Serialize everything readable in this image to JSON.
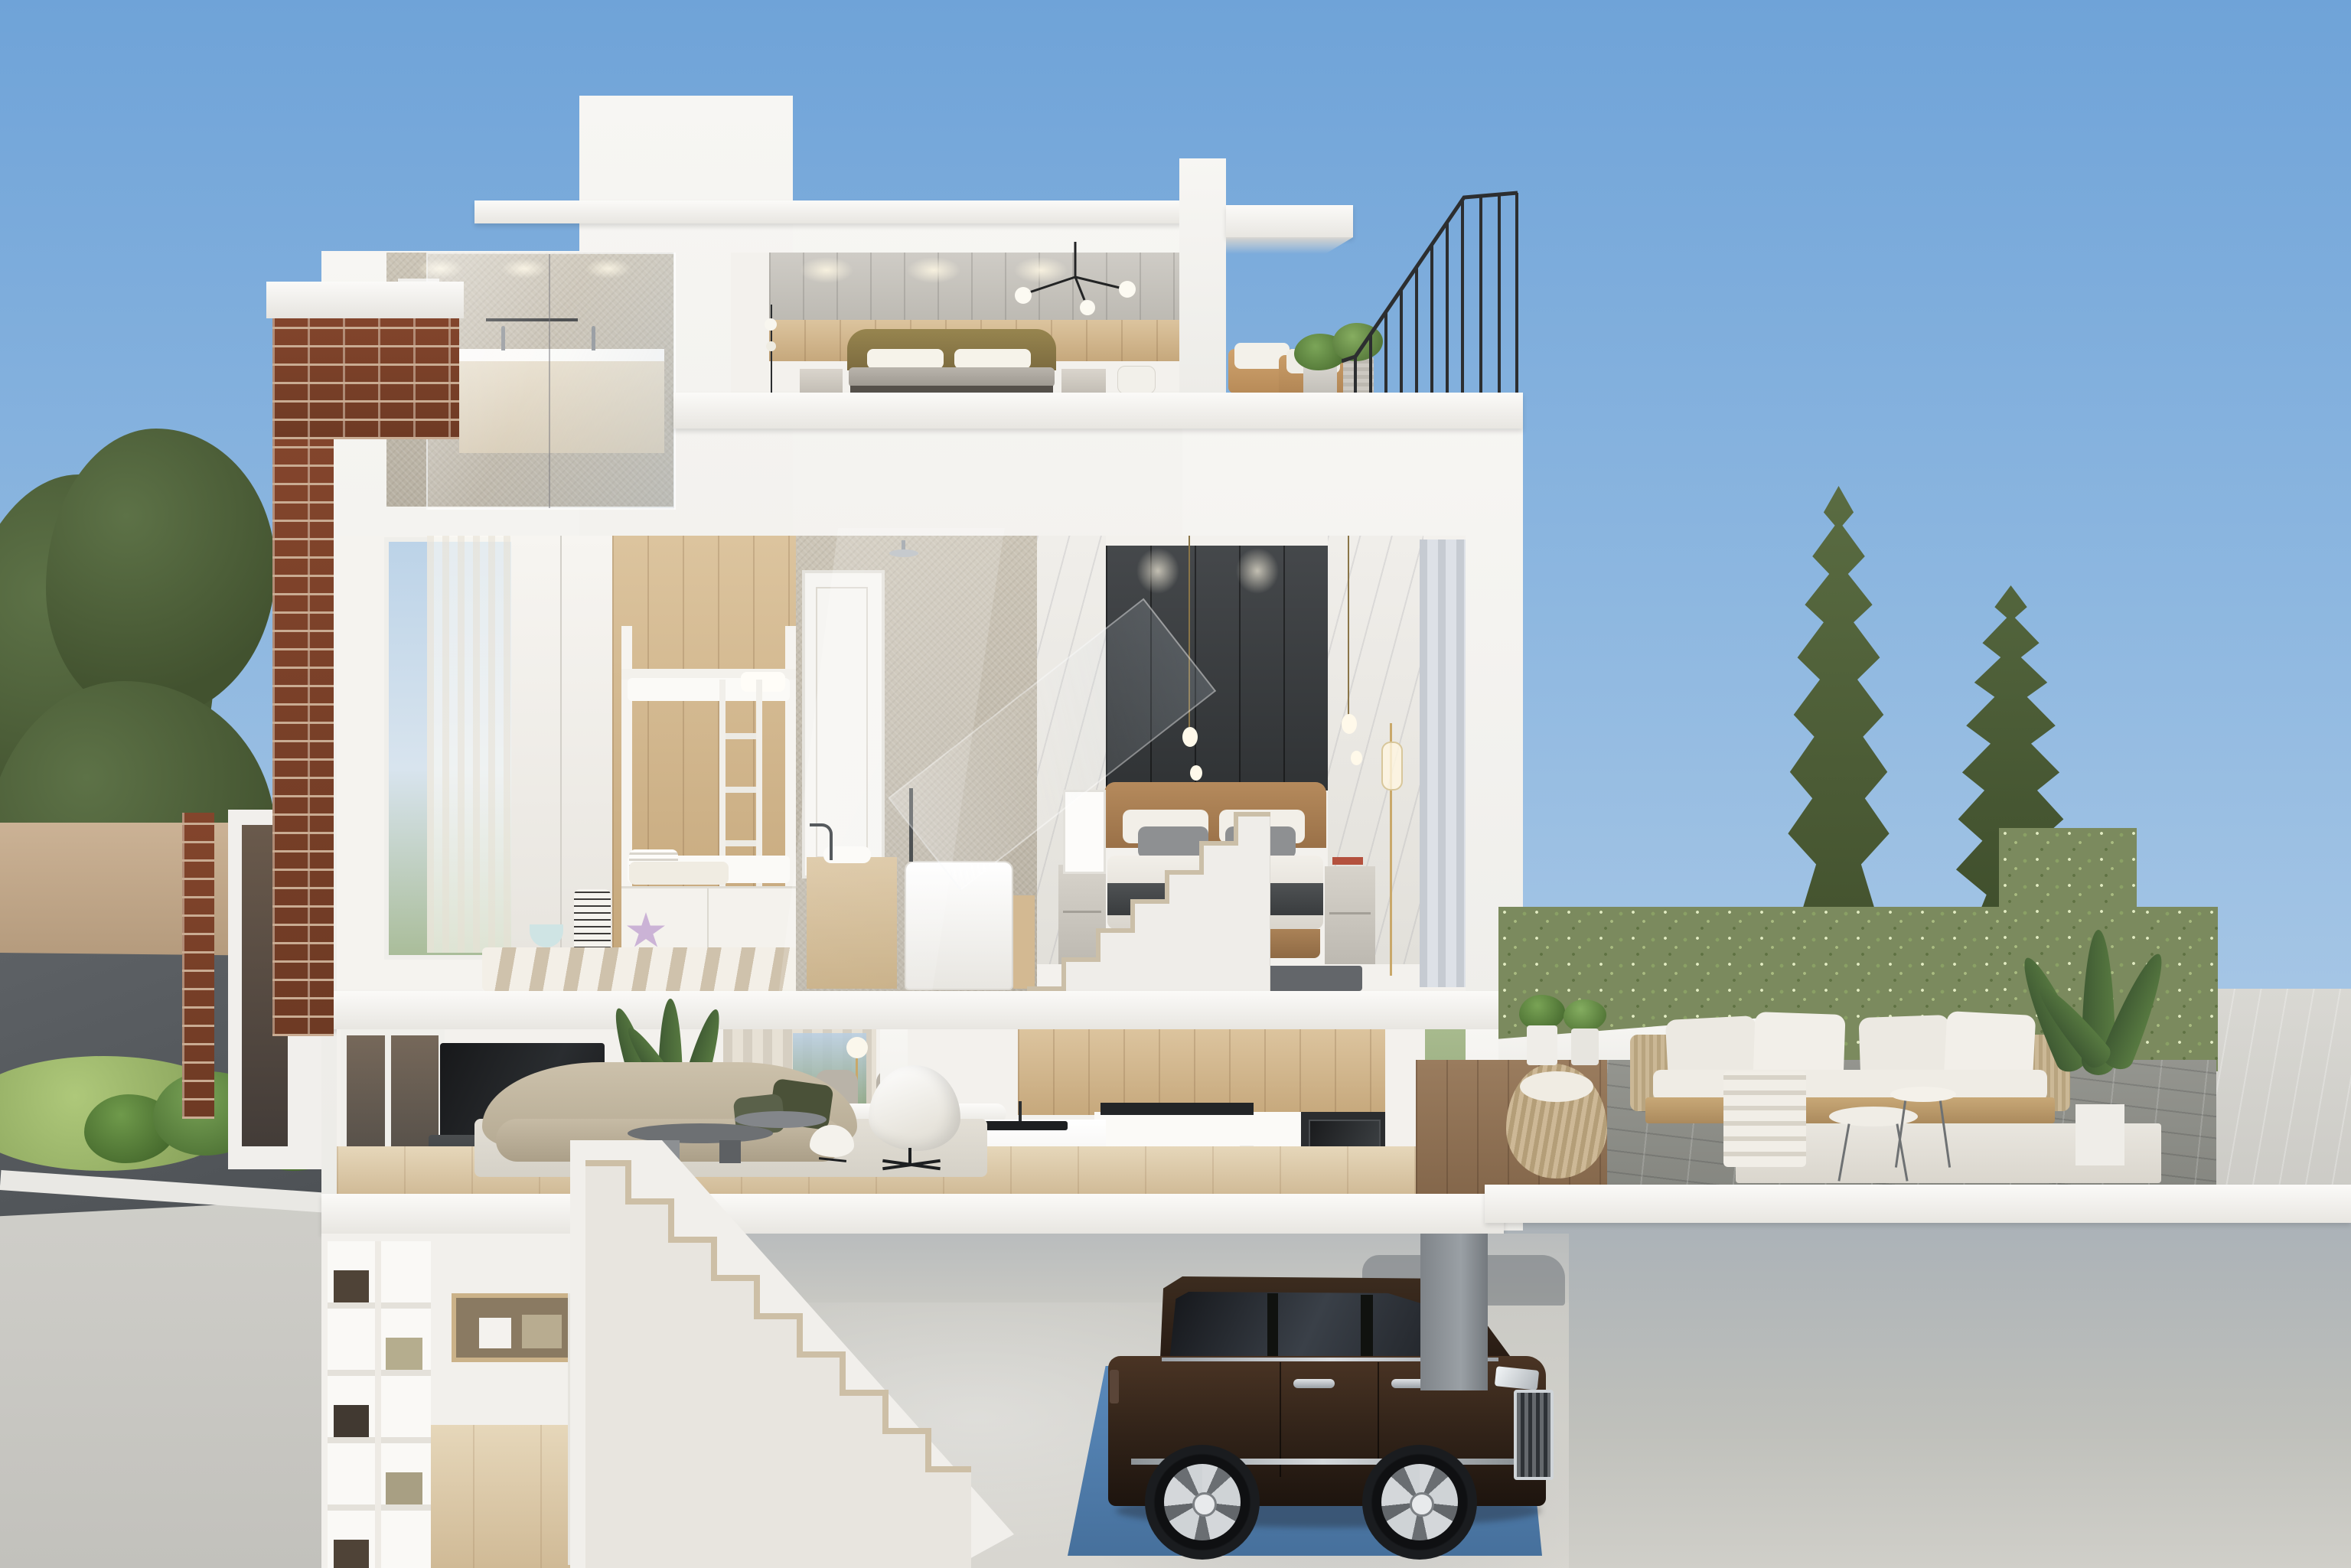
{
  "scene": {
    "type": "architectural-cutaway-render",
    "description": "Cross-section 3D rendering of a four-level modern townhouse under a clear blue sky",
    "levels": [
      {
        "name": "roof-level",
        "rooms": [
          "bathroom",
          "bedroom",
          "roof-terrace-with-railing"
        ]
      },
      {
        "name": "third-floor",
        "rooms": [
          "kids-bunk-room",
          "bathroom-with-tub",
          "staircase",
          "master-bedroom"
        ]
      },
      {
        "name": "second-floor",
        "rooms": [
          "living-room",
          "dining-area",
          "kitchen",
          "outdoor-garden-terrace"
        ]
      },
      {
        "name": "basement",
        "rooms": [
          "storage-room",
          "staircase",
          "garage"
        ]
      }
    ],
    "exterior": [
      "sky",
      "left-trees",
      "brick-chimney",
      "timber-fence",
      "asphalt-driveway",
      "ferns",
      "cypress-trees",
      "hedge-planters",
      "street-pavement",
      "podium-wall"
    ],
    "vehicle": {
      "type": "luxury-suv",
      "body_color_name": "dark-brown",
      "location": "garage",
      "parked_on": "blue-lift-pad"
    }
  },
  "colors": {
    "sky_top": "#6fa3d8",
    "sky_mid": "#a9c8e6",
    "sky_horizon": "#d3dfec",
    "shell_white": "#f4f3f0",
    "brick": "#7a3f29",
    "brick_mortar": "#c9ab92",
    "hedge": "#7b8a5e",
    "road": "#54585c",
    "grass": "#9cb66a",
    "pad_blue": "#4e81b4",
    "car_body_dark": "#241811",
    "car_body_light": "#4a3424",
    "sofa_beige": "#c2b7a1",
    "pillow_green": "#4a5138",
    "bed_tan": "#a9845c",
    "gold": "#c9a86a",
    "tan_fence": "#c3a98e"
  }
}
